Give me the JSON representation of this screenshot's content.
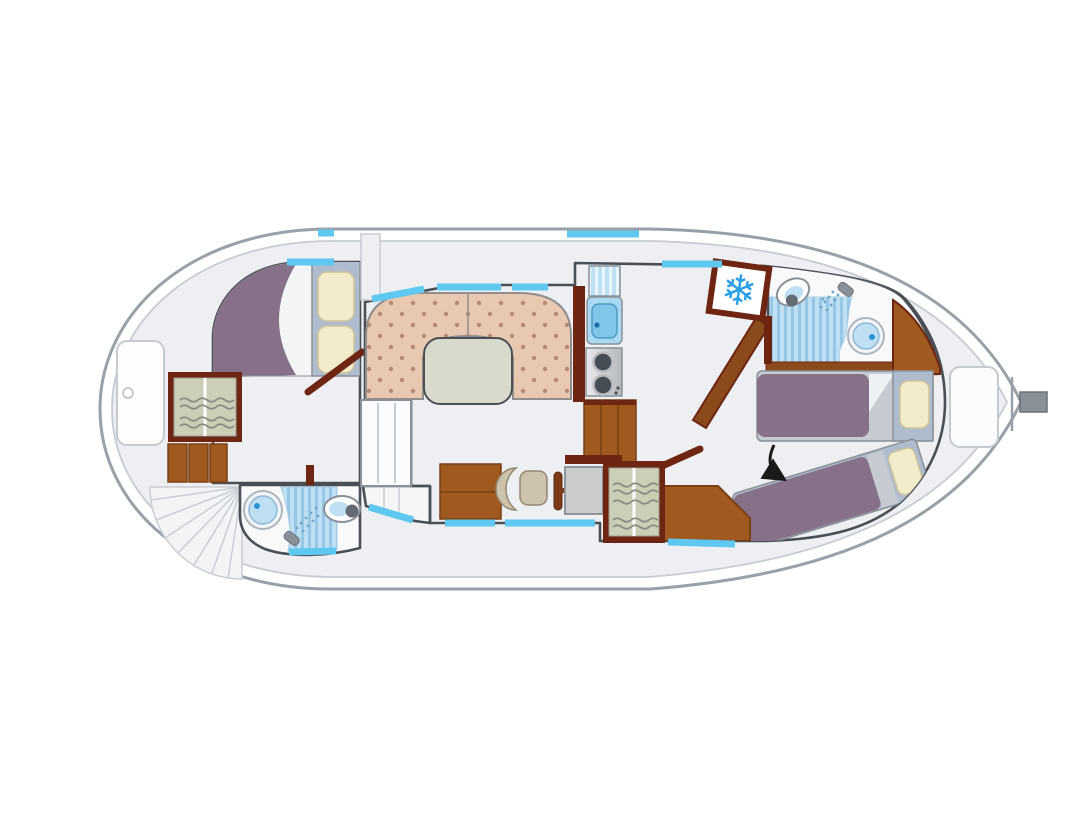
{
  "diagram": {
    "type": "floor-plan",
    "subject": "canal boat deck plan, top view, bow left and pointed stern right",
    "rooms": [
      {
        "name": "bow-deck",
        "items": [
          "deck-hatch",
          "radial-steps"
        ]
      },
      {
        "name": "forward-cabin",
        "items": [
          "double-bed",
          "two-pillows",
          "wardrobe",
          "drawers",
          "door"
        ]
      },
      {
        "name": "forward-bathroom",
        "items": [
          "washbasin",
          "shower",
          "toilet"
        ]
      },
      {
        "name": "salon",
        "items": [
          "u-shaped-sofa",
          "oval-table",
          "sideboard"
        ]
      },
      {
        "name": "galley",
        "items": [
          "draining-board",
          "sink",
          "two-burner-stove",
          "counter",
          "fridge"
        ]
      },
      {
        "name": "helm",
        "items": [
          "pilot-seat",
          "steering-wheel",
          "console",
          "cabinet",
          "wardrobe"
        ]
      },
      {
        "name": "aft-cabin",
        "items": [
          "single-bed",
          "diagonal-single-bed",
          "bench",
          "door",
          "arrow-marker"
        ]
      },
      {
        "name": "aft-bathroom",
        "items": [
          "toilet",
          "shower",
          "washbasin",
          "corner-cabinet"
        ]
      },
      {
        "name": "stern-deck",
        "items": [
          "bench-locker",
          "rudder"
        ]
      }
    ]
  },
  "icons": {
    "snowflake_glyph": "❄"
  },
  "colors": {
    "page_bg": "#ffffff",
    "hull_stroke": "#98a0a8",
    "hull_inner_line": "#c6cbd1",
    "deck": "#edeff2",
    "deck_line": "#c9ced4",
    "wall": "#4a4f55",
    "wood_light": "#fcf0d8",
    "wood_dark": "#f5d9a2",
    "maroon": "#6e2612",
    "cabinet": "#a05a1f",
    "cabinet_dark": "#7c3f12",
    "sofa": "#e9c8b2",
    "sofa_dot": "#b48b72",
    "table": "#d8dbcc",
    "duvet": "#877189",
    "bed_base": "#c6cbd2",
    "pillow_panel": "#aebccd",
    "pillow": "#f3ecca",
    "pillow_stroke": "#cfc49a",
    "bath_room": "#f7f9fa",
    "bath_blue": "#bfe0f3",
    "bath_stripe": "#96c8e6",
    "drain_stripe": "#e8f5fc",
    "window": "#5ec8f0",
    "snowflake": "#2b9fe6",
    "wardrobe": "#cdceb8",
    "shelf": "#8a8d80",
    "console": "#c9cbcd",
    "chair": "#cdc2ab",
    "chair_dark": "#93886f",
    "steel_a": "#e9eaec",
    "steel_b": "#b4b8bd",
    "burner": "#474d54",
    "rudder": "#8a9097",
    "sink_dot": "#2a93d5",
    "fixture_stroke": "#8a9097",
    "arrow": "#1a1a1a",
    "white": "#ffffff"
  }
}
